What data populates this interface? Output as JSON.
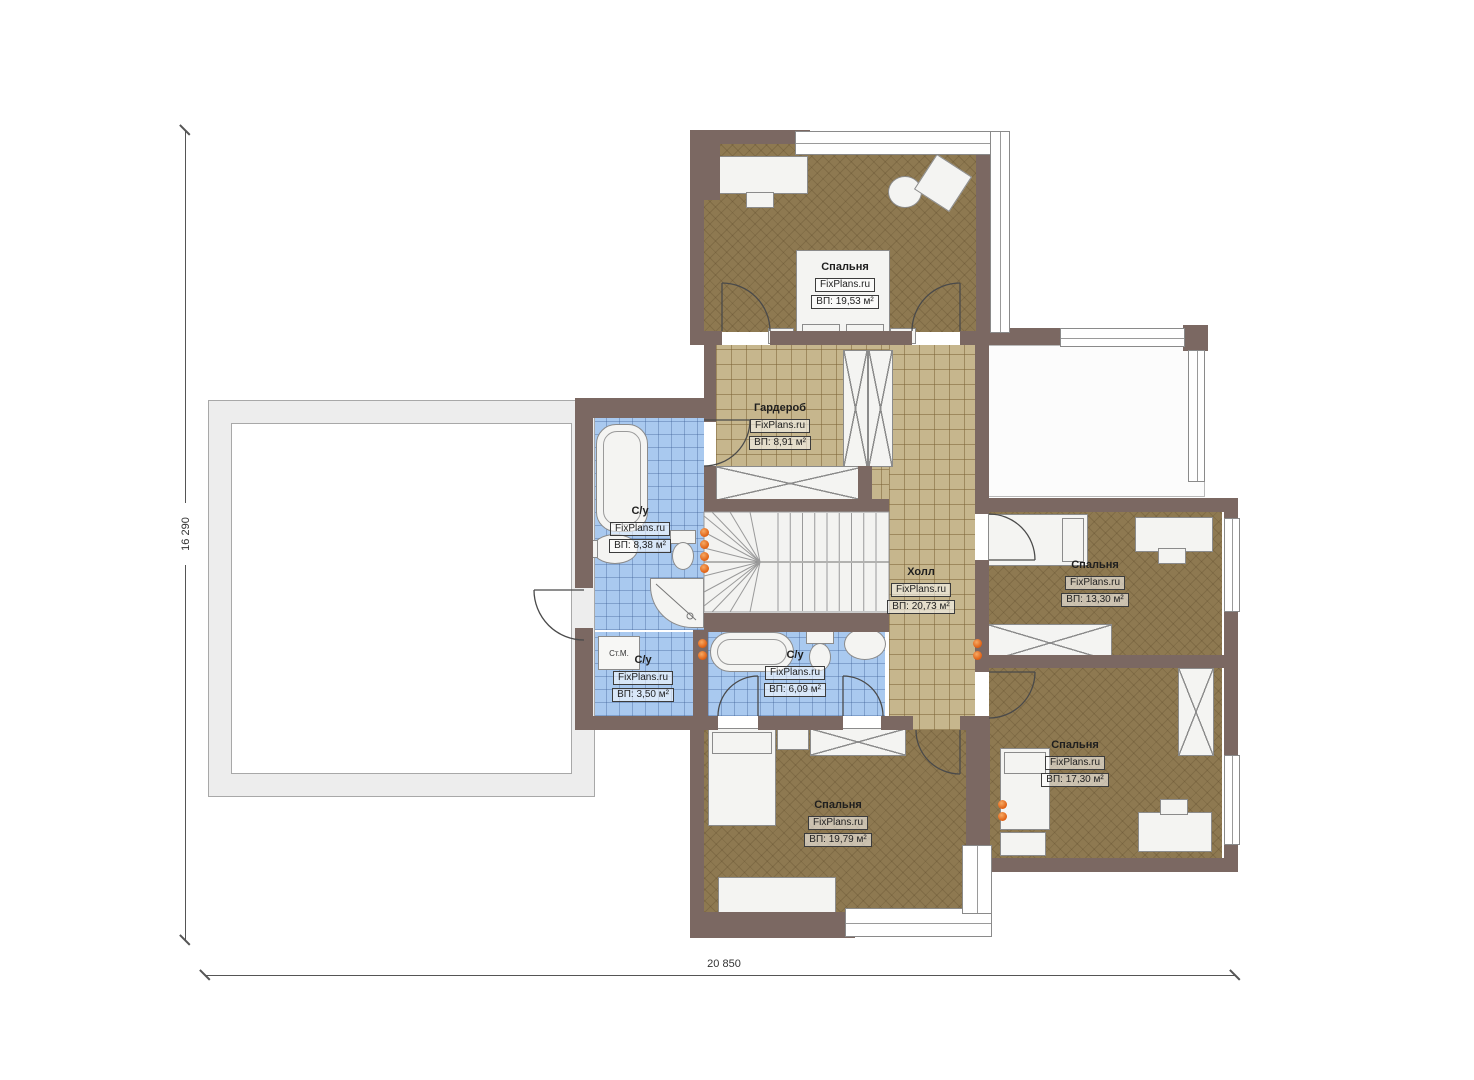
{
  "plan": {
    "dimensions": {
      "height_label": "16 290",
      "width_label": "20 850"
    },
    "watermark": "FixPlans.ru",
    "rooms": [
      {
        "id": "bedroom-top",
        "name": "Спальня",
        "brand": "FixPlans.ru",
        "area": "ВП: 19,53 м²"
      },
      {
        "id": "wardrobe",
        "name": "Гардероб",
        "brand": "FixPlans.ru",
        "area": "ВП: 8,91 м²"
      },
      {
        "id": "bathroom-left",
        "name": "С/у",
        "brand": "FixPlans.ru",
        "area": "ВП: 8,38 м²"
      },
      {
        "id": "hall",
        "name": "Холл",
        "brand": "FixPlans.ru",
        "area": "ВП: 20,73 м²"
      },
      {
        "id": "bedroom-right",
        "name": "Спальня",
        "brand": "FixPlans.ru",
        "area": "ВП: 13,30 м²"
      },
      {
        "id": "bathroom-small",
        "name": "С/у",
        "brand": "FixPlans.ru",
        "area": "ВП: 3,50 м²"
      },
      {
        "id": "bathroom-middle",
        "name": "С/у",
        "brand": "FixPlans.ru",
        "area": "ВП: 6,09 м²"
      },
      {
        "id": "bedroom-bottom-right",
        "name": "Спальня",
        "brand": "FixPlans.ru",
        "area": "ВП: 17,30 м²"
      },
      {
        "id": "bedroom-bottom",
        "name": "Спальня",
        "brand": "FixPlans.ru",
        "area": "ВП: 19,79 м²"
      }
    ],
    "labels": {
      "washing_machine": "Ст.М."
    },
    "colors": {
      "wall": "#7b6862",
      "wood_floor": "#8e7951",
      "tile_tan": "#c6b68d",
      "tile_blue": "#a9c9ef",
      "radiator": "#df5f12"
    }
  }
}
